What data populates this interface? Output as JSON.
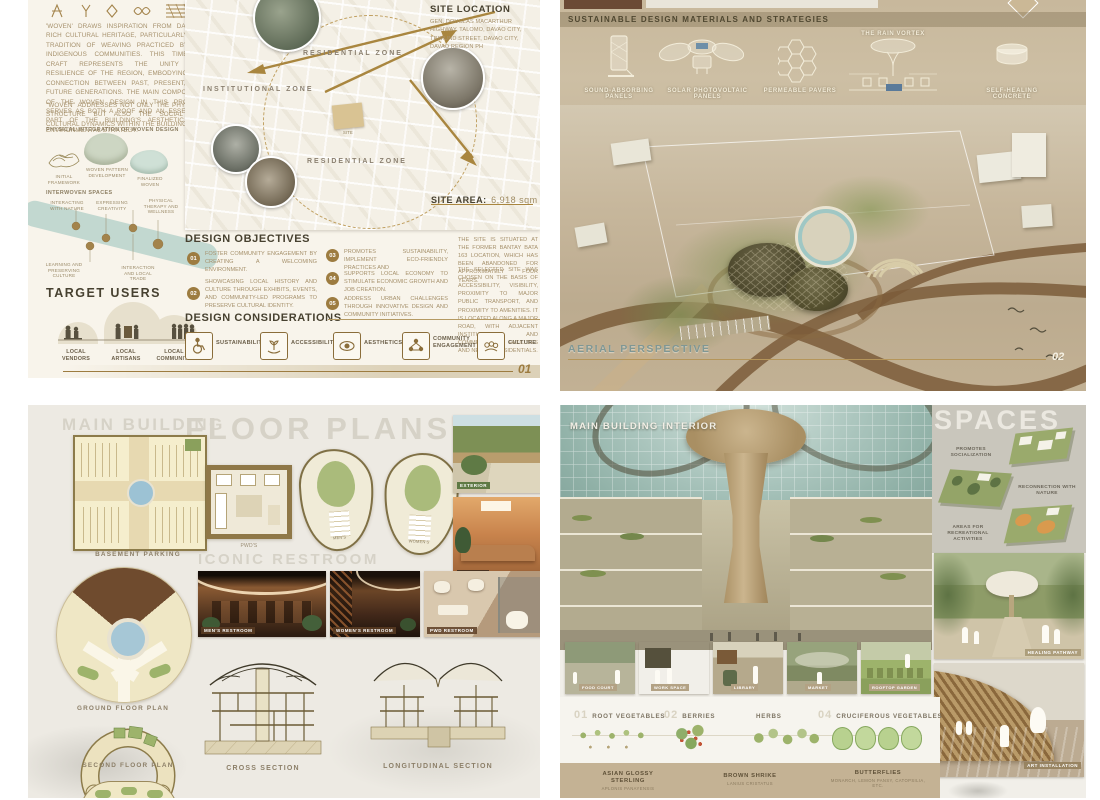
{
  "panel1": {
    "intro_p1": "'WOVEN' DRAWS INSPIRATION FROM DAVAO'S RICH CULTURAL HERITAGE, PARTICULARLY THE TRADITION OF WEAVING PRACTICED BY ITS INDIGENOUS COMMUNITIES. THIS TIMELESS CRAFT REPRESENTS THE UNITY AND RESILIENCE OF THE REGION, EMBODYING THE CONNECTION BETWEEN PAST, PRESENT, AND FUTURE GENERATIONS. THE MAIN COMPONENT OF THE WOVEN DESIGN IN THIS PROJECT SERVES AS BOTH A ROOF AND AN ESSENTIAL PART OF THE BUILDING'S AESTHETIC AND ENVIRONMENTAL STRATEGY.",
    "intro_p2": "\"WOVEN\" ADDRESSES NOT ONLY THE PHYSICAL STRUCTURE BUT ALSO THE SOCIAL AND CULTURAL DYNAMICS WITHIN THE BUILDING.",
    "integration_title": "PHYSICAL INTEGRATION OF WOVEN DESIGN",
    "steps": [
      "INITIAL FRAMEWORK",
      "WOVEN PATTERN DEVELOPMENT",
      "FINALIZED WOVEN"
    ],
    "interwoven_title": "INTERWOVEN SPACES",
    "interwoven": [
      "INTERACTING WITH NATURE",
      "EXPRESSING CREATIVITY",
      "PHYSICAL THERAPY AND WELLNESS",
      "LEARNING AND PRESERVING CULTURE",
      "INTERACTION AND LOCAL TRADE"
    ],
    "target_title": "TARGET USERS",
    "users": [
      "LOCAL VENDORS",
      "LOCAL ARTISANS",
      "LOCAL COMMUNITY"
    ],
    "map": {
      "title": "SITE LOCATION",
      "address": "GEN. DOUGLAS MACARTHUR HIGHWAY, TALOMO, DAVAO CITY, TRIMUND STREET, DAVAO CITY, DAVAO REGION PH",
      "zone_res1": "RESIDENTIAL ZONE",
      "zone_inst": "INSTITUTIONAL ZONE",
      "zone_res2": "RESIDENTIAL ZONE",
      "site_tag": "SITE",
      "area_label": "SITE AREA:",
      "area_value": "6,918 sqm"
    },
    "objectives_title": "DESIGN OBJECTIVES",
    "objectives": [
      {
        "num": "01",
        "text": "FOSTER COMMUNITY ENGAGEMENT BY CREATING A WELCOMING ENVIRONMENT."
      },
      {
        "num": "02",
        "text": "SHOWCASING LOCAL HISTORY AND CULTURE THROUGH EXHIBITS, EVENTS, AND COMMUNITY-LED PROGRAMS TO PRESERVE CULTURAL IDENTITY."
      },
      {
        "num": "03",
        "text": "PROMOTES SUSTAINABILITY, IMPLEMENT ECO-FRIENDLY PRACTICES AND"
      },
      {
        "num": "04",
        "text": "SUPPORTS LOCAL ECONOMY TO STIMULATE ECONOMIC GROWTH AND JOB CREATION."
      },
      {
        "num": "05",
        "text": "ADDRESS URBAN CHALLENGES THROUGH INNOVATIVE DESIGN AND COMMUNITY INITIATIVES."
      }
    ],
    "site_p1": "THE SITE IS SITUATED AT THE FORMER BANTAY BATA 163 LOCATION, WHICH HAS BEEN ABANDONED FOR APPROXIMATELY FOUR YEARS.",
    "site_p2": "THE SELECTED SITE WAS CHOSEN ON THE BASIS OF ACCESSIBILITY, VISIBILITY, PROXIMITY TO MAJOR PUBLIC TRANSPORT, AND PROXIMITY TO AMENITIES. IT IS LOCATED ALONG A MAJOR ROAD, WITH ADJACENT INSTITUTIONAL AND COMMERCIAL FACILITIES AND NEARBY RESIDENTIALS.",
    "considerations_title": "DESIGN CONSIDERATIONS",
    "considerations": [
      "SUSTAINABILITY",
      "ACCESSIBILITY",
      "AESTHETICS",
      "COMMUNITY ENGAGEMENT",
      "CULTURE"
    ],
    "page": "01"
  },
  "panel2": {
    "header": "SUSTAINABLE DESIGN MATERIALS AND STRATEGIES",
    "materials": [
      "SOUND-ABSORBING PANELS",
      "SOLAR PHOTOVOLTAIC PANELS",
      "PERMEABLE PAVERS",
      "THE RAIN VORTEX",
      "SELF-HEALING CONCRETE"
    ],
    "aerial_label": "AERIAL PERSPECTIVE",
    "page": "02"
  },
  "panel3": {
    "main_building": "MAIN BUILDING",
    "floor_plans": "FLOOR PLANS",
    "basement": "BASEMENT PARKING",
    "ground": "GROUND FLOOR PLAN",
    "second": "SECOND FLOOR PLAN",
    "pwds": "PWD'S",
    "mens_plan": "MEN'S",
    "womens_plan": "WOMEN'S",
    "iconic": "ICONIC RESTROOM",
    "restrooms": [
      "MEN'S RESTROOM",
      "WOMEN'S RESTROOM",
      "PWD RESTROOM"
    ],
    "exterior": "EXTERIOR",
    "interior": "INTERIOR",
    "cross": "CROSS SECTION",
    "longitudinal": "LONGITUDINAL SECTION"
  },
  "panel4": {
    "interior_label": "MAIN BUILDING INTERIOR",
    "spaces_title": "SPACES",
    "diagram_labels": [
      "PROMOTES SOCIALIZATION",
      "RECONNECTION WITH NATURE",
      "AREAS FOR RECREATIONAL ACTIVITIES"
    ],
    "pathway_label": "HEALING PATHWAY",
    "art_label": "ART INSTALLATION",
    "thumbs": [
      "FOOD COURT",
      "WORK SPACE",
      "LIBRARY",
      "MARKET",
      "ROOFTOP GARDEN"
    ],
    "garden": [
      {
        "num": "01",
        "label": "ROOT VEGETABLES"
      },
      {
        "num": "02",
        "label": "BERRIES"
      },
      {
        "num": "03",
        "label": "HERBS"
      },
      {
        "num": "04",
        "label": "CRUCIFEROUS VEGETABLES"
      }
    ],
    "fauna": [
      {
        "name": "ASIAN GLOSSY STERLING",
        "sub": "APLONIS PANAYENSIS"
      },
      {
        "name": "BROWN SHRIKE",
        "sub": "LANIUS CRISTATUS"
      },
      {
        "name": "BUTTERFLIES",
        "sub": "MONARCH, LEMON PANSY, CATOPSILIA, ETC."
      }
    ]
  }
}
